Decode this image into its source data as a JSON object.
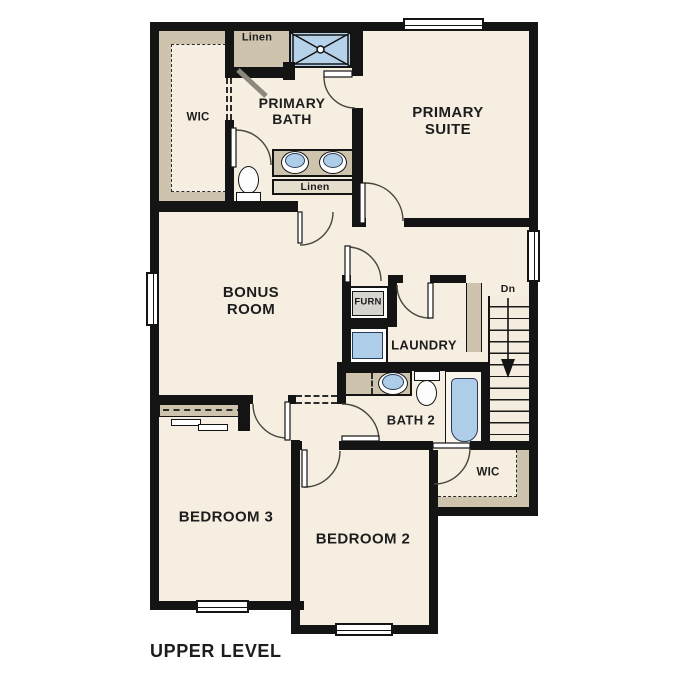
{
  "plan": {
    "title": "UPPER LEVEL",
    "rooms": {
      "primary_suite": "PRIMARY SUITE",
      "primary_bath": "PRIMARY BATH",
      "bonus_room": "BONUS ROOM",
      "laundry": "LAUNDRY",
      "bath2": "BATH 2",
      "bedroom2": "BEDROOM 2",
      "bedroom3": "BEDROOM 3",
      "wic_primary": "WIC",
      "wic_bedroom2": "WIC"
    },
    "closets": {
      "linen_hall": "Linen",
      "linen_vanity": "Linen"
    },
    "equipment": {
      "furnace": "FURN"
    },
    "stairs": {
      "direction": "Dn"
    },
    "colors": {
      "wall": "#141414",
      "floor": "#f5eee1",
      "casework_tan": "#cec4ad",
      "fixture_blue": "#aecde9",
      "background": "#ffffff"
    }
  }
}
